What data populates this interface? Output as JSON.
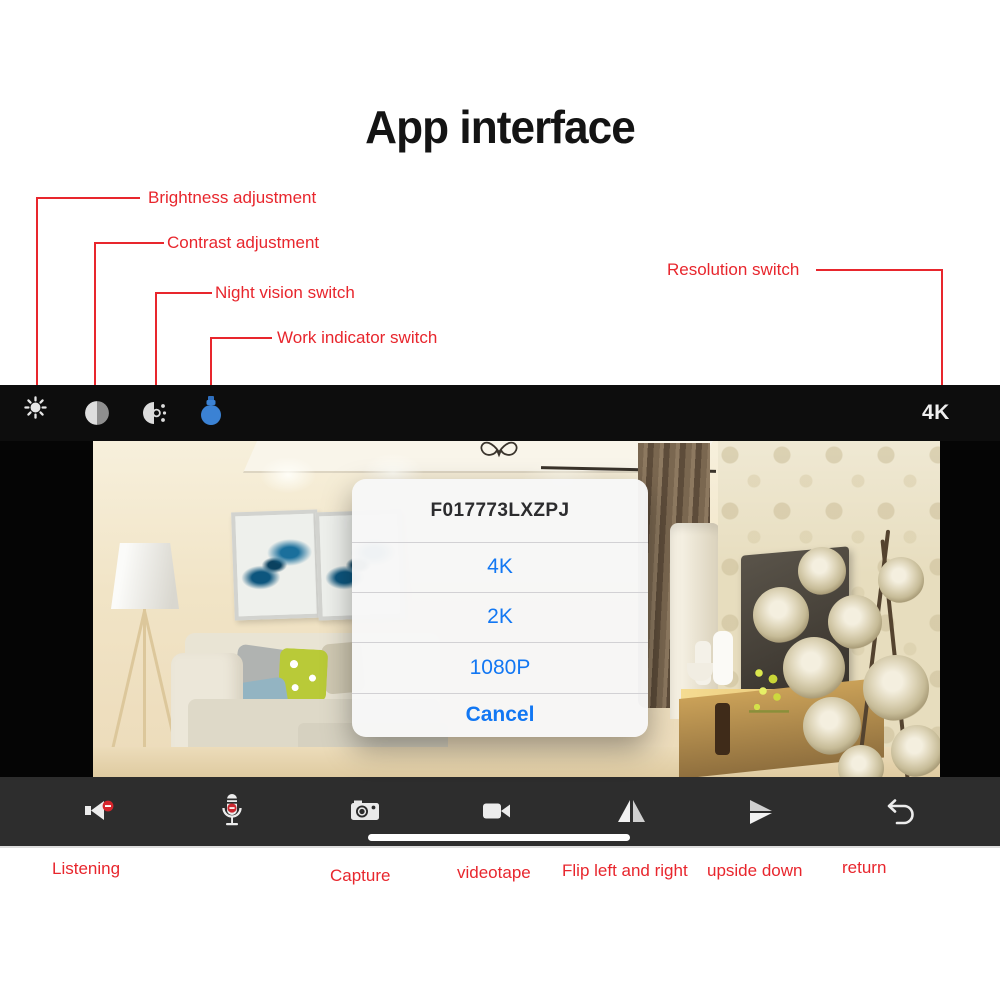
{
  "page": {
    "title": "App interface"
  },
  "annotations": {
    "brightness": "Brightness adjustment",
    "contrast": "Contrast adjustment",
    "night_vision": "Night vision switch",
    "work_indicator": "Work indicator switch",
    "resolution": "Resolution switch"
  },
  "top_bar": {
    "resolution_value": "4K",
    "icons": [
      "brightness-icon",
      "contrast-icon",
      "night-vision-icon",
      "work-indicator-icon"
    ]
  },
  "dialog": {
    "title": "F017773LXZPJ",
    "options": [
      "4K",
      "2K",
      "1080P"
    ],
    "cancel": "Cancel"
  },
  "bottom_bar": {
    "icons": [
      "speaker-icon",
      "microphone-icon",
      "camera-icon",
      "camcorder-icon",
      "flip-horizontal-icon",
      "flip-vertical-icon",
      "return-icon"
    ]
  },
  "bottom_labels": {
    "listening": "Listening",
    "capture": "Capture",
    "videotape": "videotape",
    "flip": "Flip left and right",
    "upside_down": "upside down",
    "return_label": "return"
  },
  "colors": {
    "annotation_red": "#e8262d",
    "dialog_blue": "#1277f3",
    "bulb_blue": "#3b82d4",
    "top_bar_bg": "#0d0d0d",
    "bottom_bar_bg": "#2d2d2d"
  }
}
